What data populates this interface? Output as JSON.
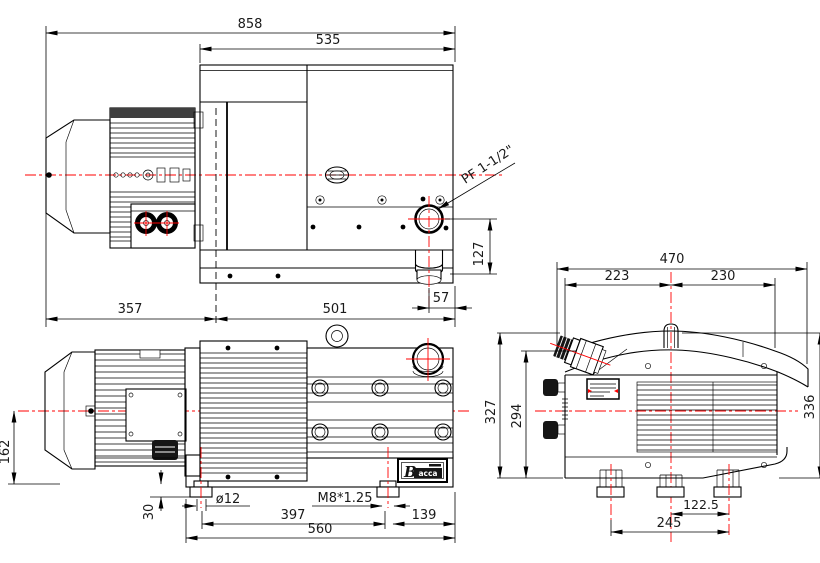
{
  "colors": {
    "line": "#000000",
    "centerline": "#ff0000",
    "background": "#ffffff",
    "text": "#1a1a1a"
  },
  "dims": {
    "overall_length": "858",
    "pump_length": "535",
    "motor_section_length": "357",
    "pump_section_length": "501",
    "exhaust_port_height": "127",
    "exhaust_port_offset": "57",
    "exhaust_port_thread": "PF 1-1/2\"",
    "shaft_height": "162",
    "foot_height": "30",
    "foot_hole_diameter": "ø12",
    "foot_hole_thread": "M8*1.25",
    "foot_hole_spacing": "397",
    "rear_foot_offset": "139",
    "base_length": "560",
    "overall_width": "470",
    "width_left_of_center": "223",
    "width_right_of_center": "230",
    "overall_height": "327",
    "inlet_height": "294",
    "cover_height": "336",
    "foot_center_offset": "122.5",
    "foot_spacing": "245"
  },
  "nameplate": {
    "brand_initial": "B",
    "brand_text": "acca"
  }
}
